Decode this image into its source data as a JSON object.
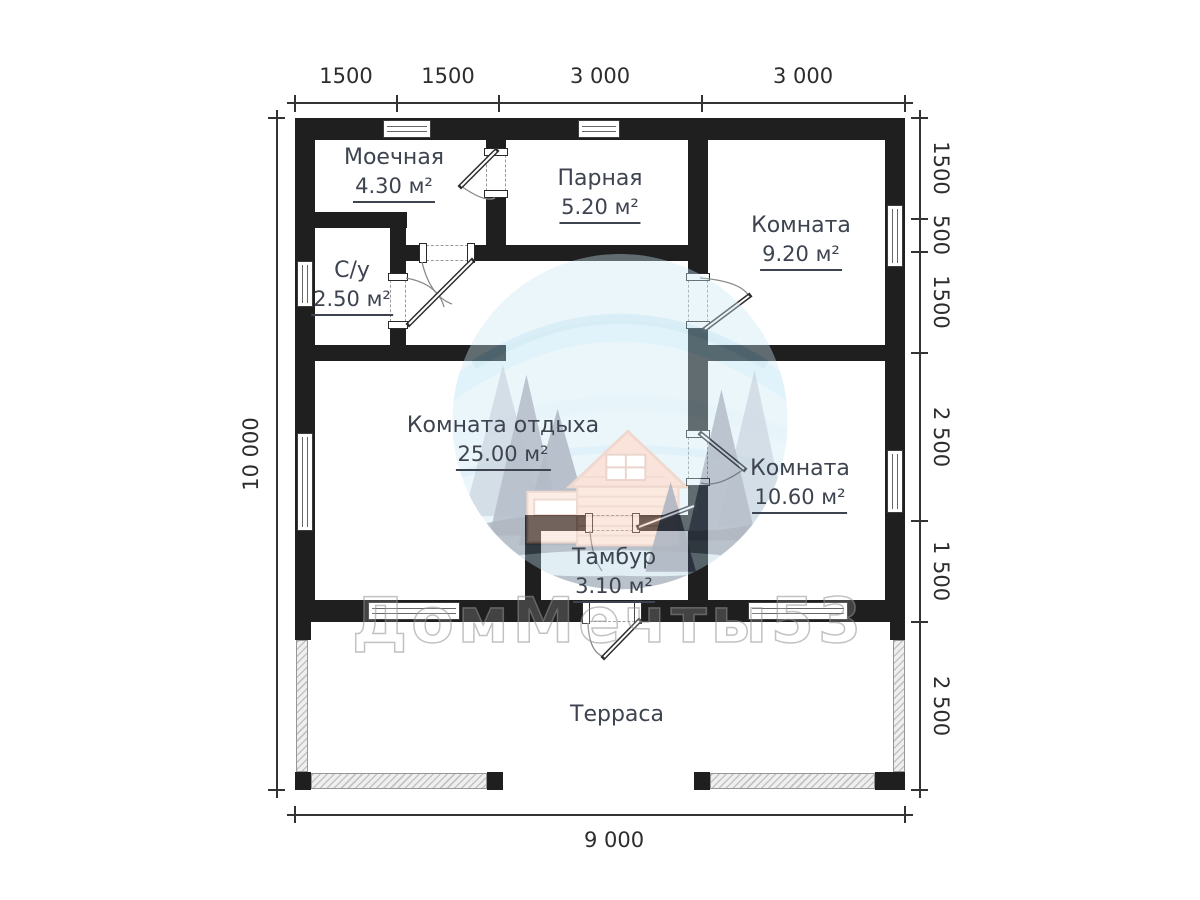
{
  "dimensions": {
    "top": [
      "1500",
      "1500",
      "3 000",
      "3 000"
    ],
    "right": [
      "1500",
      "500",
      "1500",
      "2 500",
      "1 500",
      "2 500"
    ],
    "left": [
      "10 000"
    ],
    "bottom": [
      "9 000"
    ]
  },
  "rooms": [
    {
      "name": "Моечная",
      "area": "4.30 м²"
    },
    {
      "name": "Парная",
      "area": "5.20 м²"
    },
    {
      "name": "Комната",
      "area": "9.20 м²"
    },
    {
      "name": "С/у",
      "area": "2.50 м²"
    },
    {
      "name": "Комната отдыха",
      "area": "25.00 м²"
    },
    {
      "name": "Комната",
      "area": "10.60 м²"
    },
    {
      "name": "Тамбур",
      "area": "3.10 м²"
    },
    {
      "name": "Терраса",
      "area": ""
    }
  ],
  "watermark": {
    "brand": "ДомМечты53"
  },
  "colors": {
    "wall": "#1f1f1f",
    "room_label": "#3d4450",
    "dimension_text": "#2d2d2d",
    "terrace_hatch": "#c3c3c3",
    "logo_sky": "#cdeaf7",
    "logo_trees": "#415876",
    "logo_house": "#f6c3ab"
  }
}
